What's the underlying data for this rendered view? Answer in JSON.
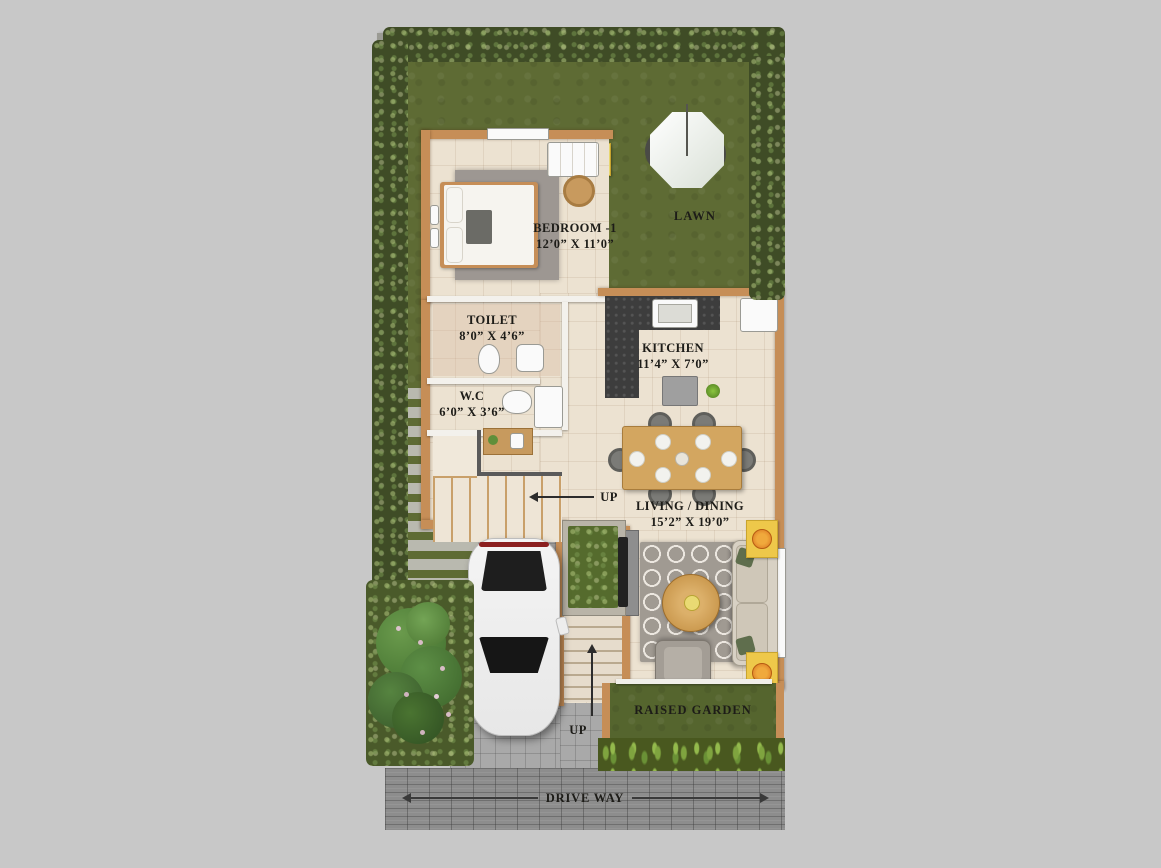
{
  "rooms": {
    "bedroom": {
      "name": "BEDROOM -1",
      "dims": "12’0” X 11’0”"
    },
    "toilet": {
      "name": "TOILET",
      "dims": "8’0” X 4’6”"
    },
    "wc": {
      "name": "W.C",
      "dims": "6’0” X 3’6”"
    },
    "kitchen": {
      "name": "KITCHEN",
      "dims": "11’4” X 7’0”"
    },
    "living": {
      "name": "LIVING / DINING",
      "dims": "15’2” X 19’0”"
    }
  },
  "outdoor": {
    "lawn": "LAWN",
    "raised_garden": "RAISED GARDEN",
    "driveway": "DRIVE WAY"
  },
  "stairs": {
    "up_main": "UP",
    "up_entry": "UP"
  },
  "colors": {
    "background": "#c8c8c8",
    "lawn_green": "#5e6b34",
    "hedge_green": "#3f4c26",
    "floor_cream": "#ece2d1",
    "wall_tan": "#c68e57",
    "counter_black": "#3d3d3d",
    "driveway_gray": "#8d8d8d",
    "porch_gray": "#a9a9a9",
    "accent_yellow": "#eec84a",
    "wood": "#d3a660",
    "label_text": "#1d1c18"
  }
}
